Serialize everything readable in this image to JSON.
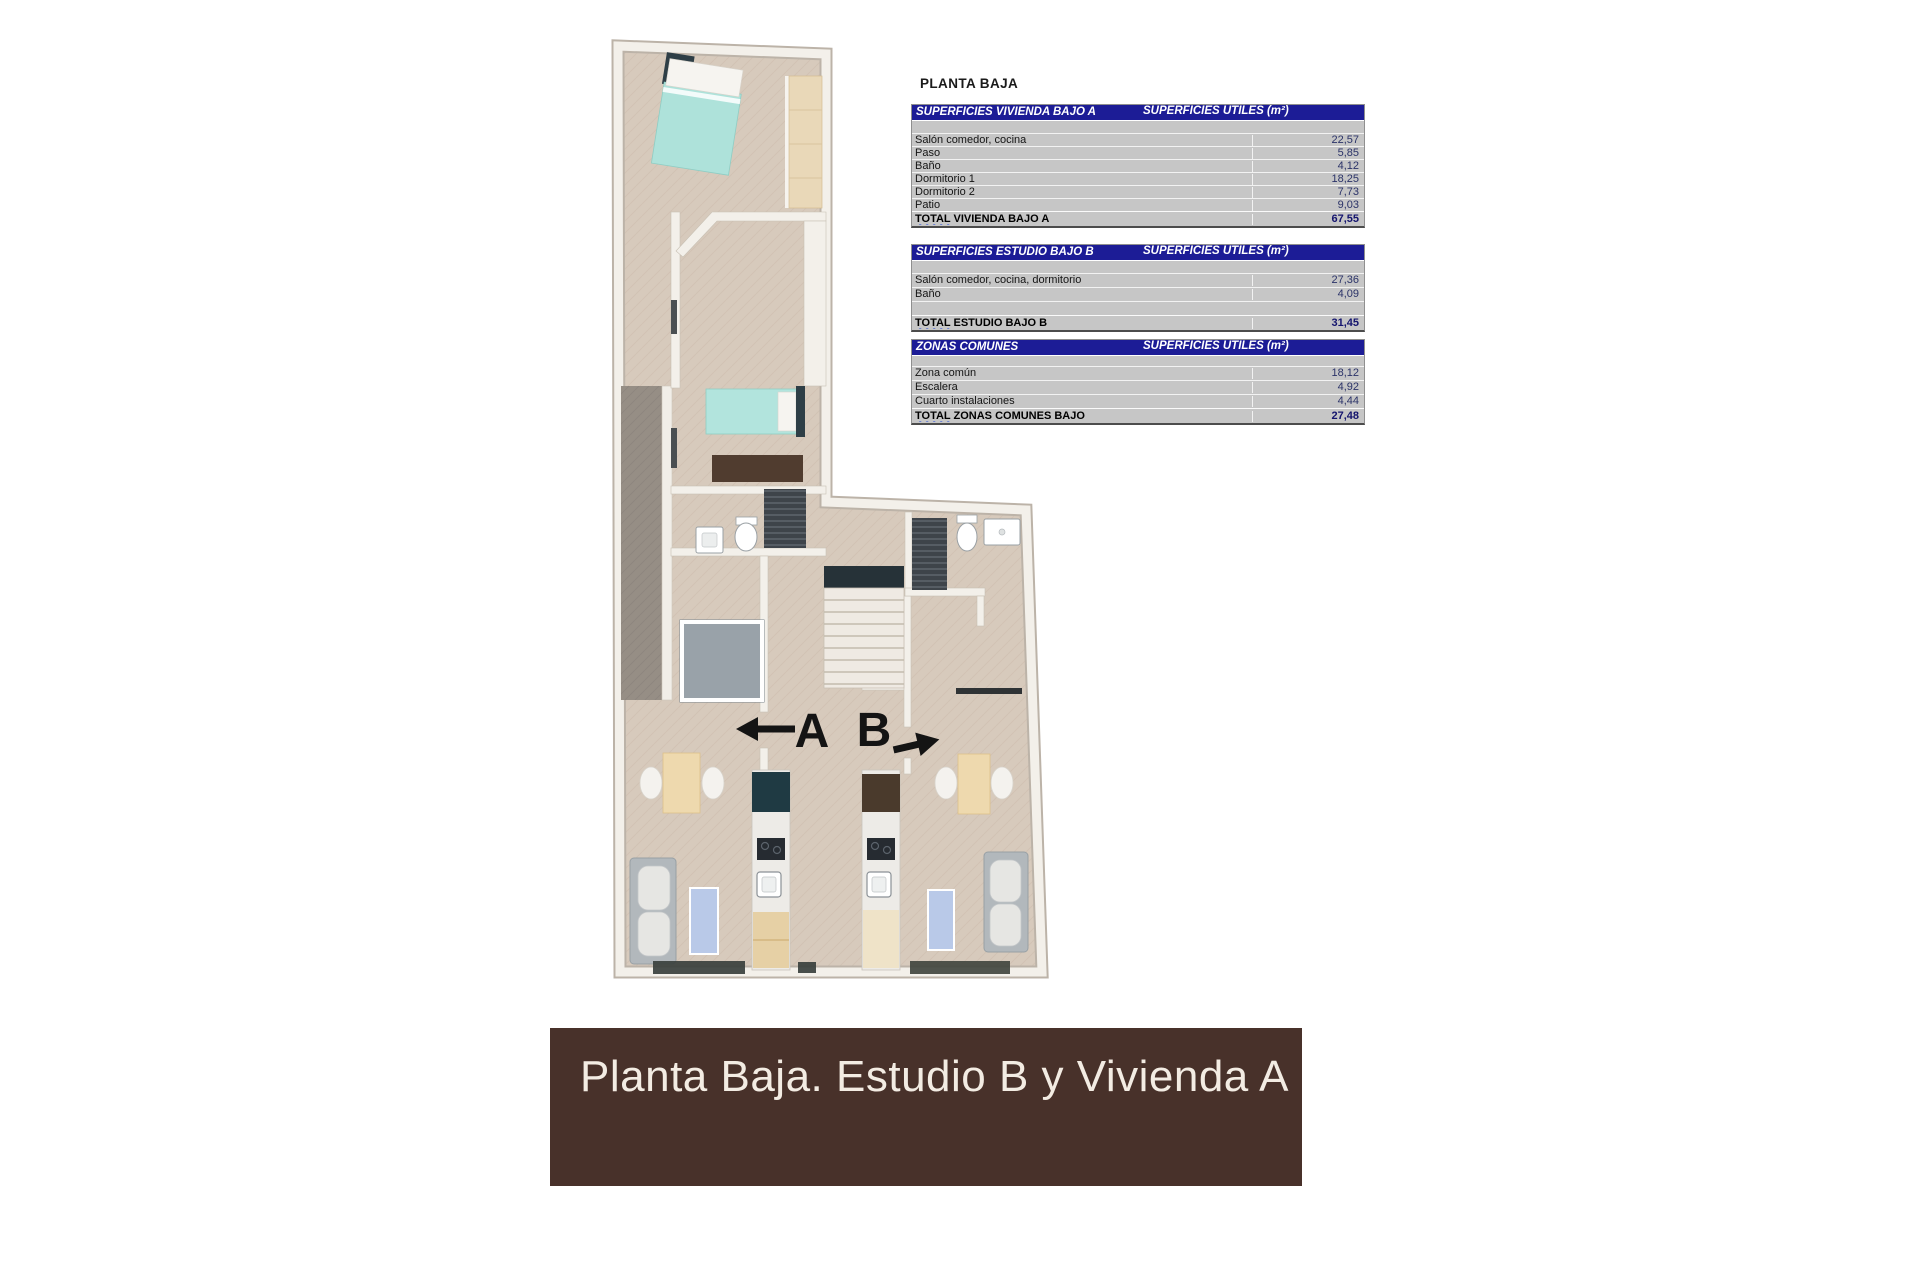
{
  "sheet": {
    "title": "PLANTA BAJA"
  },
  "plan": {
    "unit_a_label": "A",
    "unit_b_label": "B",
    "colors": {
      "floor": "#d7cabc",
      "patio": "#968e85",
      "wall": "#f3f0ea",
      "bed": "#aee2da",
      "headboard": "#2e3e46",
      "wood": "#e9d8b8",
      "sofa": "#b2b8bc",
      "rug": "#b9c9e8",
      "kitchen_dark": "#1f3a43",
      "banner_brown": "#48312a",
      "table_header_navy": "#1c1c96"
    }
  },
  "tables": {
    "value_header": "SUPERFICIES UTILES  (m²)",
    "items": [
      {
        "header": "SUPERFICIES VIVIENDA BAJO A",
        "rows": [
          {
            "label": "Salón comedor, cocina",
            "value": "22,57"
          },
          {
            "label": "Paso",
            "value": "5,85"
          },
          {
            "label": "Baño",
            "value": "4,12"
          },
          {
            "label": "Dormitorio 1",
            "value": "18,25"
          },
          {
            "label": "Dormitorio 2",
            "value": "7,73"
          },
          {
            "label": "Patio",
            "value": "9,03"
          }
        ],
        "total": {
          "word": "TOTAL",
          "rest": " VIVIENDA BAJO A",
          "value": "67,55"
        }
      },
      {
        "header": "SUPERFICIES ESTUDIO BAJO B",
        "rows": [
          {
            "label": "Salón comedor, cocina, dormitorio",
            "value": "27,36"
          },
          {
            "label": "Baño",
            "value": "4,09"
          },
          {
            "label": "",
            "value": ""
          }
        ],
        "total": {
          "word": "TOTAL",
          "rest": " ESTUDIO BAJO B",
          "value": "31,45"
        }
      },
      {
        "header": "ZONAS COMUNES",
        "rows": [
          {
            "label": "Zona común",
            "value": "18,12"
          },
          {
            "label": "Escalera",
            "value": "4,92"
          },
          {
            "label": "Cuarto instalaciones",
            "value": "4,44"
          }
        ],
        "total": {
          "word": "TOTAL",
          "rest": " ZONAS COMUNES BAJO",
          "value": "27,48"
        }
      }
    ]
  },
  "banner": {
    "text": "Planta Baja. Estudio B y Vivienda A"
  }
}
